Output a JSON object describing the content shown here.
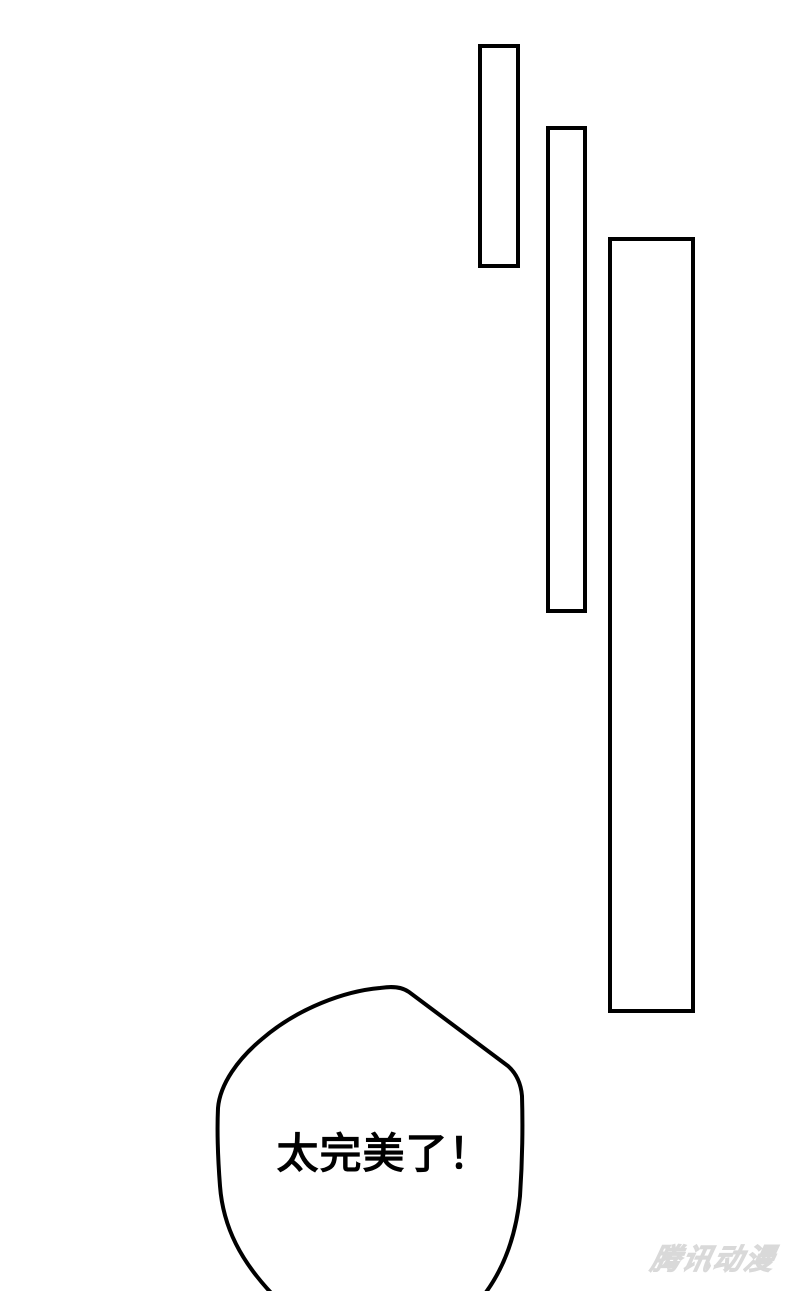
{
  "page": {
    "background_color": "#ffffff",
    "line_color": "#000000"
  },
  "speech_bubble": {
    "text": "太完美了！"
  },
  "watermark": {
    "text": "腾讯动漫",
    "color": "#e2e2e2"
  }
}
